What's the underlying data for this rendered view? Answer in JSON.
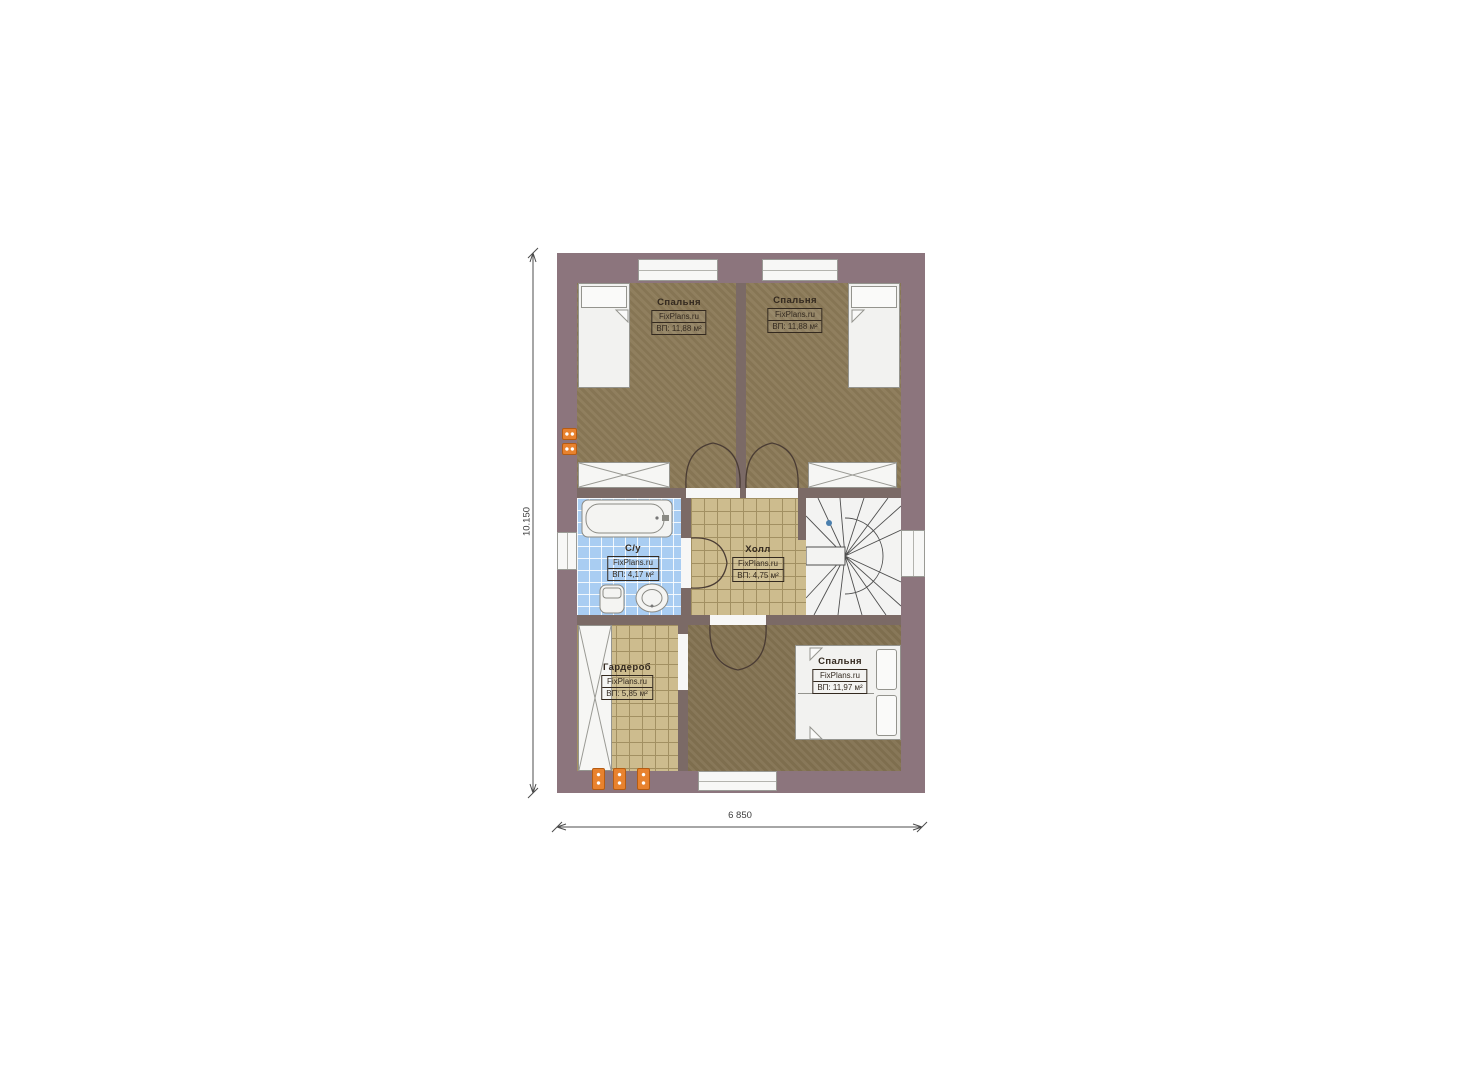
{
  "plan": {
    "rooms": [
      {
        "key": "bedroom-top-left",
        "name": "Спальня",
        "watermark": "FixPlans.ru",
        "area": "ВП: 11,88 м²"
      },
      {
        "key": "bedroom-top-right",
        "name": "Спальня",
        "watermark": "FixPlans.ru",
        "area": "ВП: 11,88 м²"
      },
      {
        "key": "bathroom",
        "name": "С/у",
        "watermark": "FixPlans.ru",
        "area": "ВП: 4,17 м²"
      },
      {
        "key": "hall",
        "name": "Холл",
        "watermark": "FixPlans.ru",
        "area": "ВП: 4,75 м²"
      },
      {
        "key": "wardrobe",
        "name": "Гардероб",
        "watermark": "FixPlans.ru",
        "area": "ВП: 5,85 м²"
      },
      {
        "key": "bedroom-bottom",
        "name": "Спальня",
        "watermark": "FixPlans.ru",
        "area": "ВП: 11,97 м²"
      }
    ],
    "dimensions": {
      "vertical": "10.150",
      "horizontal": "6 850"
    }
  },
  "colors": {
    "wall": "#8c757d",
    "wallInner": "#7b6a66",
    "carpet": "#8b7a58",
    "carpetDark": "#837252",
    "tileTan": "#cdbc8e",
    "tileTanLine": "#a29062",
    "tileBlue": "#a9cdf2",
    "stairBg": "#f3f3f2",
    "lineDark": "#4a3c34",
    "furnitureFill": "#f2f2f0",
    "furnitureLine": "#94948e",
    "radiator": "#e8822e",
    "dimLine": "#4c4c4c",
    "text": "#33291f",
    "stairDot": "#4a7fae"
  }
}
